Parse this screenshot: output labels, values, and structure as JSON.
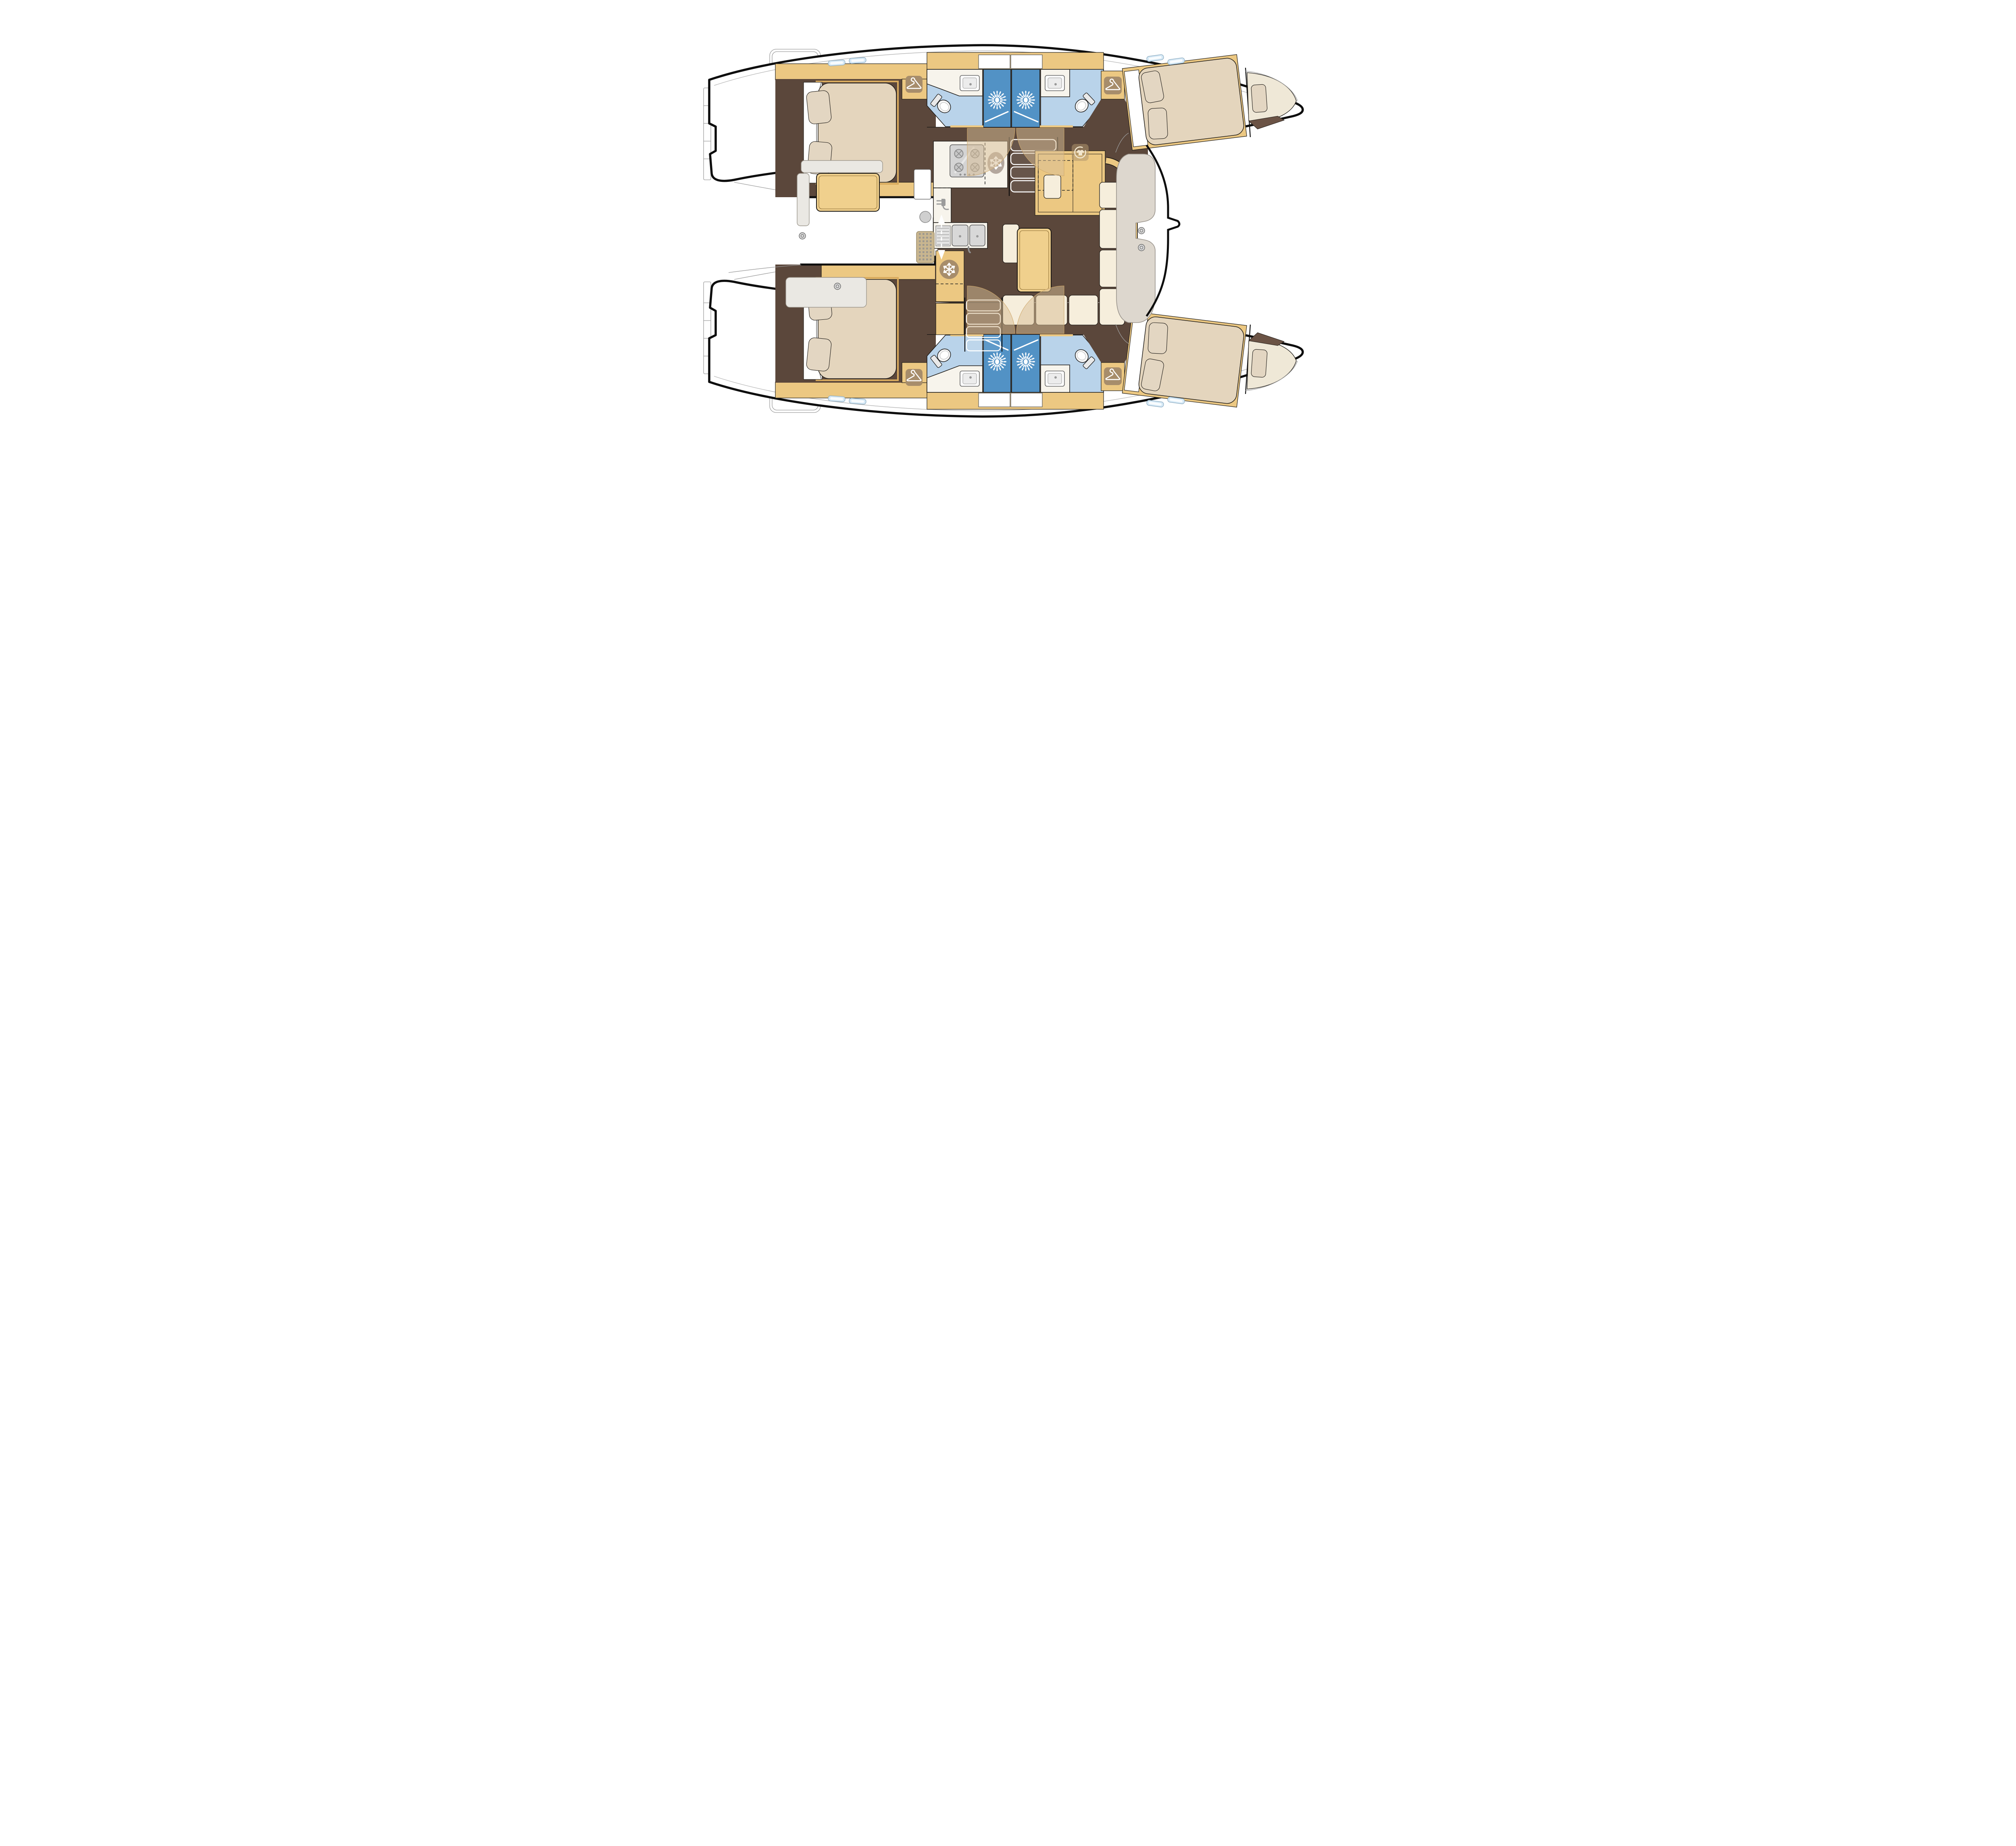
{
  "document": {
    "kind": "catamaran-yacht-interior-floor-plan",
    "view": "top-down layout drawing, bows pointing right",
    "cabin_count": 4,
    "bathroom_count": 4,
    "shower_stall_count": 4
  },
  "colors": {
    "hull_fill": "#ffffff",
    "outline": "#0d0d0d",
    "line": "#1d1a16",
    "ext_line": "#9c9c9c",
    "wood": "#ecc882",
    "wood_table": "#f0d08d",
    "floor": "#5b473b",
    "sweep": "rgba(217,189,150,0.52)",
    "mattress": "#e4d5bd",
    "mattress_light": "#efe8d7",
    "pillow": "#e3d6c2",
    "sofa": "#f6eedc",
    "bench": "#eae8e3",
    "seat": "#ddd7ce",
    "bath": "#b9d3ea",
    "shower": "#5292c5",
    "counter": "#f7f4ec",
    "icon_tan": "#a78d6b",
    "fridge_grey": "#b3a79e",
    "steel": "#d2d2d2",
    "grating": "#c9b68f",
    "hatch": "#d6e9f6"
  },
  "rooms": [
    {
      "id": "salon",
      "label": "Saloon with U-shaped sofa and dining table"
    },
    {
      "id": "galley",
      "label": "U-shaped galley with stove, fridge and double sink"
    },
    {
      "id": "nav",
      "label": "Chart cabinet with optional washing machine"
    },
    {
      "id": "cockpit",
      "label": "Aft cockpit with table and benches"
    },
    {
      "id": "fwd-cockpit",
      "label": "Forward cockpit with C-shaped seat and winches"
    },
    {
      "id": "cabin",
      "label": "Double cabin with island berth"
    },
    {
      "id": "head",
      "label": "Bathroom with toilet and washbasin"
    },
    {
      "id": "shower",
      "label": "Separate shower stall"
    },
    {
      "id": "corridor",
      "label": "Hull corridor"
    },
    {
      "id": "forepeak",
      "label": "Forepeak berth"
    },
    {
      "id": "transom",
      "label": "Transom steps and swim platform"
    },
    {
      "id": "foredeck",
      "label": "Foredeck between the bows"
    },
    {
      "id": "stairs",
      "label": "Companionway steps down into hull"
    }
  ],
  "icons": [
    {
      "name": "hanger-icon",
      "meaning": "hanging wardrobe",
      "count": 4
    },
    {
      "name": "shower-spray-icon",
      "meaning": "shower stall",
      "count": 4
    },
    {
      "name": "snowflake-icon",
      "meaning": "refrigerator / freezer",
      "count": 2
    },
    {
      "name": "power-socket-icon",
      "meaning": "galley power outlet",
      "count": 1
    },
    {
      "name": "washing-machine-icon",
      "meaning": "optional washing machine",
      "count": 1
    },
    {
      "name": "winch-icon",
      "meaning": "deck winch",
      "count": 4
    },
    {
      "name": "double-arrow-icon",
      "meaning": "sliding entry door",
      "count": 1
    },
    {
      "name": "stove-icon",
      "meaning": "4-burner cooktop",
      "count": 1
    },
    {
      "name": "double-sink-icon",
      "meaning": "galley twin sink",
      "count": 1
    },
    {
      "name": "toilet-icon",
      "meaning": "marine toilet",
      "count": 4
    },
    {
      "name": "basin-icon",
      "meaning": "washbasin",
      "count": 4
    }
  ]
}
